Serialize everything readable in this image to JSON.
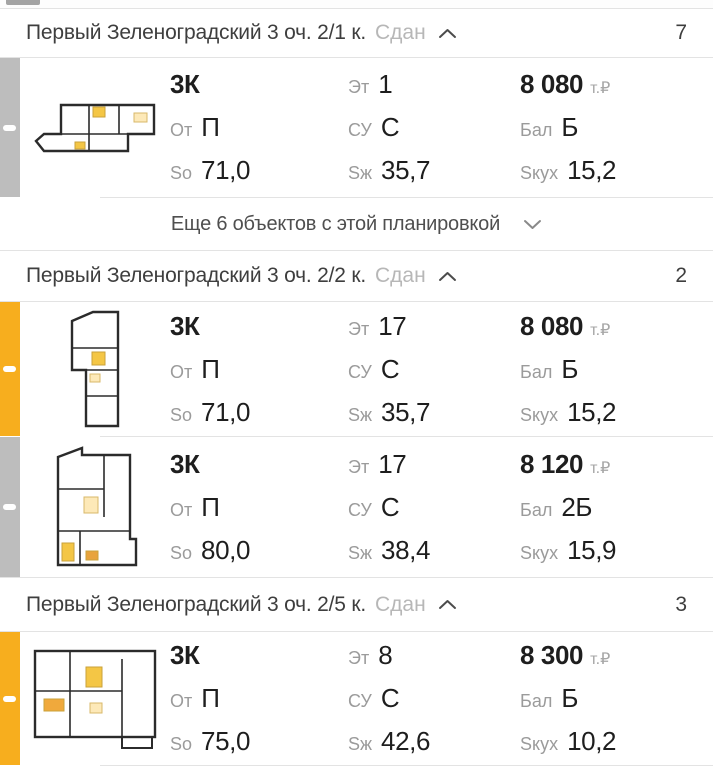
{
  "colors": {
    "accent_yellow": "#f7ae1e",
    "bar_gray": "#bdbdbd",
    "divider": "#e3e3e3",
    "label_gray": "#9b9b9b",
    "text_dark": "#1e1e1e"
  },
  "sections": [
    {
      "title": "Первый Зеленоградский 3 оч. 2/1 к.",
      "status": "Сдан",
      "count": "7",
      "more_label": "Еще 6 объектов с этой планировкой",
      "listings": [
        {
          "bar": "gray",
          "rooms": "3К",
          "ot_label": "От",
          "ot": "П",
          "so_label": "So",
          "so": "71,0",
          "et_label": "Эт",
          "et": "1",
          "su_label": "СУ",
          "su": "С",
          "szh_label": "Sж",
          "szh": "35,7",
          "price": "8 080",
          "price_unit": "т.₽",
          "bal_label": "Бал",
          "bal": "Б",
          "skuh_label": "Sкух",
          "skuh": "15,2"
        }
      ]
    },
    {
      "title": "Первый Зеленоградский 3 оч. 2/2 к.",
      "status": "Сдан",
      "count": "2",
      "listings": [
        {
          "bar": "yellow",
          "rooms": "3К",
          "ot_label": "От",
          "ot": "П",
          "so_label": "So",
          "so": "71,0",
          "et_label": "Эт",
          "et": "17",
          "su_label": "СУ",
          "su": "С",
          "szh_label": "Sж",
          "szh": "35,7",
          "price": "8 080",
          "price_unit": "т.₽",
          "bal_label": "Бал",
          "bal": "Б",
          "skuh_label": "Sкух",
          "skuh": "15,2"
        },
        {
          "bar": "gray",
          "rooms": "3К",
          "ot_label": "От",
          "ot": "П",
          "so_label": "So",
          "so": "80,0",
          "et_label": "Эт",
          "et": "17",
          "su_label": "СУ",
          "su": "С",
          "szh_label": "Sж",
          "szh": "38,4",
          "price": "8 120",
          "price_unit": "т.₽",
          "bal_label": "Бал",
          "bal": "2Б",
          "skuh_label": "Sкух",
          "skuh": "15,9"
        }
      ]
    },
    {
      "title": "Первый Зеленоградский 3 оч. 2/5 к.",
      "status": "Сдан",
      "count": "3",
      "listings": [
        {
          "bar": "yellow",
          "rooms": "3К",
          "ot_label": "От",
          "ot": "П",
          "so_label": "So",
          "so": "75,0",
          "et_label": "Эт",
          "et": "8",
          "su_label": "СУ",
          "su": "С",
          "szh_label": "Sж",
          "szh": "42,6",
          "price": "8 300",
          "price_unit": "т.₽",
          "bal_label": "Бал",
          "bal": "Б",
          "skuh_label": "Sкух",
          "skuh": "10,2"
        }
      ]
    }
  ]
}
